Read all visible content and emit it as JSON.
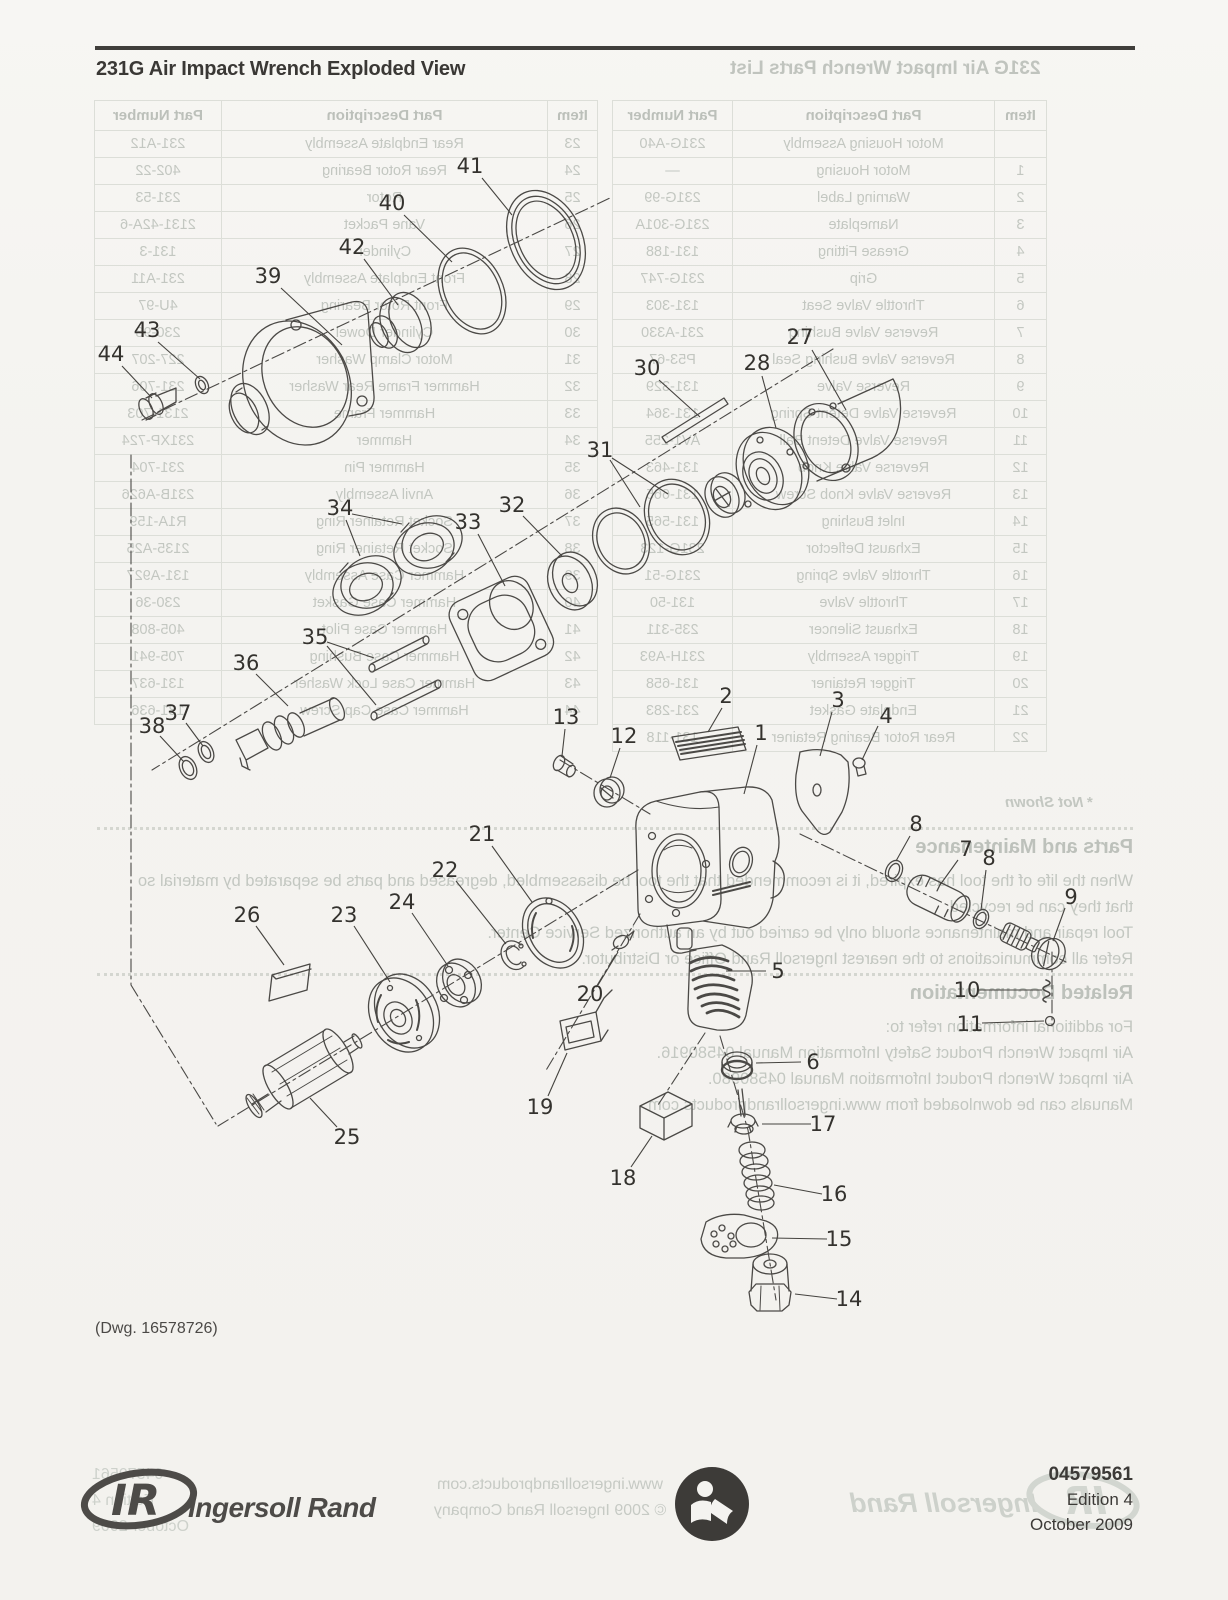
{
  "page": {
    "title": "231G Air Impact Wrench Exploded View",
    "dwg_note": "(Dwg. 16578726)"
  },
  "bleed": {
    "title": "231G Air Impact Wrench Parts List",
    "not_shown": "* Not Shown",
    "table": {
      "headers": [
        "Item",
        "Part Description",
        "Part Number"
      ],
      "rows_1_22": [
        [
          "",
          "Motor Housing Assembly",
          "231G-A40"
        ],
        [
          "1",
          "Motor Housing",
          "—"
        ],
        [
          "2",
          "Warning Label",
          "231G-99"
        ],
        [
          "3",
          "Nameplate",
          "231G-301A"
        ],
        [
          "4",
          "Grease Fitting",
          "131-188"
        ],
        [
          "5",
          "Grip",
          "231G-747"
        ],
        [
          "6",
          "Throttle Valve Seat",
          "131-303"
        ],
        [
          "7",
          "Reverse Valve Bushing",
          "231-A330"
        ],
        [
          "8",
          "Reverse Valve Bushing Seal",
          "P53-67"
        ],
        [
          "9",
          "Reverse Valve",
          "131-329"
        ],
        [
          "10",
          "Reverse Valve Detent Spring",
          "131-364"
        ],
        [
          "11",
          "Reverse Valve Detent Ball",
          "AV1-255"
        ],
        [
          "12",
          "Reverse Valve Knob",
          "131-463"
        ],
        [
          "13",
          "Reverse Valve Knob Screw",
          "131-665"
        ],
        [
          "14",
          "Inlet Bushing",
          "131-565"
        ],
        [
          "15",
          "Exhaust Deflector",
          "231G-123"
        ],
        [
          "16",
          "Throttle Valve Spring",
          "231G-51"
        ],
        [
          "17",
          "Throttle Valve",
          "131-50"
        ],
        [
          "18",
          "Exhaust Silencer",
          "235-311"
        ],
        [
          "19",
          "Trigger Assembly",
          "231H-A93"
        ],
        [
          "20",
          "Trigger Retainer",
          "131-658"
        ],
        [
          "21",
          "Endplate Gasket",
          "231-283"
        ],
        [
          "22",
          "Rear Rotor Bearing Retainer",
          "131-118"
        ]
      ],
      "rows_23_44": [
        [
          "23",
          "Rear Endplate Assembly",
          "231-A12"
        ],
        [
          "24",
          "Rear Rotor Bearing",
          "402-22"
        ],
        [
          "25",
          "Rotor",
          "231-53"
        ],
        [
          "26",
          "Vane Packet",
          "2131-42A-6"
        ],
        [
          "27",
          "Cylinder",
          "131-3"
        ],
        [
          "28",
          "Front Endplate Assembly",
          "231-A11"
        ],
        [
          "29",
          "Front Rotor Bearing",
          "4U-97"
        ],
        [
          "30",
          "Cylinder Dowel",
          "230-98"
        ],
        [
          "31",
          "Motor Clamp Washer",
          "227-207"
        ],
        [
          "32",
          "Hammer Frame Rear Washer",
          "231-706"
        ],
        [
          "33",
          "Hammer Frame",
          "2131-703"
        ],
        [
          "34",
          "Hammer",
          "231XP-724"
        ],
        [
          "35",
          "Hammer Pin",
          "231-704"
        ],
        [
          "36",
          "Anvil Assembly",
          "231B-A626"
        ],
        [
          "37",
          "Socket Retainer Ring",
          "R1A-159"
        ],
        [
          "38",
          "Socket Retainer Ring",
          "2135-A25"
        ],
        [
          "39",
          "Hammer Case Assembly",
          "131-A927"
        ],
        [
          "40",
          "Hammer Case Gasket",
          "230-36"
        ],
        [
          "41",
          "Hammer Case Pilot",
          "405-808"
        ],
        [
          "42",
          "Hammer Case Bushing",
          "705-941"
        ],
        [
          "43",
          "Hammer Case Lock Washer",
          "131-637"
        ],
        [
          "44",
          "Hammer Case Cap Screw",
          "131-636"
        ]
      ]
    },
    "sections": [
      {
        "heading": "Parts and Maintenance",
        "top": 836,
        "lines": [
          "When the life of the tool has expired, it is recommended that the tool be disassembled, degreased and parts be separated by material so",
          "that they can be recycled.",
          "Tool repair and maintenance should only be carried out by an authorized Service Center.",
          "Refer all communications to the nearest Ingersoll Rand Office or Distributor."
        ]
      },
      {
        "heading": "Related Documentation",
        "top": 982,
        "lines": [
          "For additional information refer to:",
          "Air Impact Wrench Product Safety Information Manual 04580916.",
          "Air Impact Wrench Product Information Manual 04580980.",
          "Manuals can be downloaded from www.ingersollrandproducts.com"
        ]
      }
    ],
    "footer_center": [
      "www.ingersollrandproducts.com",
      "© 2009 Ingersoll Rand Company"
    ],
    "footer_left": [
      "04579561",
      "Edition 4",
      "October 2009"
    ],
    "footer_brand": "Ingersoll Rand"
  },
  "footer": {
    "logo_text": "IR",
    "brand": "Ingersoll Rand",
    "doc_number": "04579561",
    "edition": "Edition 4",
    "date": "October 2009"
  },
  "diagram": {
    "callouts": [
      {
        "n": "41",
        "x": 470,
        "y": 166,
        "leaders": [
          [
            482,
            178,
            512,
            215
          ]
        ]
      },
      {
        "n": "40",
        "x": 392,
        "y": 203,
        "leaders": [
          [
            404,
            215,
            452,
            262
          ]
        ]
      },
      {
        "n": "42",
        "x": 352,
        "y": 247,
        "leaders": [
          [
            364,
            259,
            398,
            305
          ]
        ]
      },
      {
        "n": "39",
        "x": 268,
        "y": 276,
        "leaders": [
          [
            281,
            288,
            342,
            345
          ]
        ]
      },
      {
        "n": "43",
        "x": 147,
        "y": 330,
        "leaders": [
          [
            158,
            342,
            200,
            379
          ]
        ]
      },
      {
        "n": "44",
        "x": 111,
        "y": 354,
        "leaders": [
          [
            122,
            366,
            152,
            398
          ]
        ]
      },
      {
        "n": "27",
        "x": 800,
        "y": 337,
        "leaders": [
          [
            812,
            350,
            846,
            410
          ]
        ]
      },
      {
        "n": "28",
        "x": 757,
        "y": 363,
        "leaders": [
          [
            762,
            376,
            776,
            428
          ]
        ]
      },
      {
        "n": "30",
        "x": 647,
        "y": 368,
        "leaders": [
          [
            659,
            380,
            700,
            417
          ]
        ]
      },
      {
        "n": "31",
        "x": 600,
        "y": 450,
        "leaders": [
          [
            610,
            460,
            640,
            507
          ],
          [
            612,
            458,
            668,
            494
          ]
        ]
      },
      {
        "n": "32",
        "x": 512,
        "y": 505,
        "leaders": [
          [
            523,
            516,
            562,
            556
          ]
        ]
      },
      {
        "n": "33",
        "x": 468,
        "y": 522,
        "leaders": [
          [
            478,
            534,
            505,
            586
          ]
        ]
      },
      {
        "n": "34",
        "x": 340,
        "y": 508,
        "leaders": [
          [
            346,
            520,
            360,
            556
          ],
          [
            352,
            514,
            402,
            524
          ]
        ]
      },
      {
        "n": "35",
        "x": 315,
        "y": 637,
        "leaders": [
          [
            327,
            642,
            374,
            658
          ],
          [
            327,
            646,
            376,
            705
          ]
        ]
      },
      {
        "n": "36",
        "x": 246,
        "y": 663,
        "leaders": [
          [
            256,
            674,
            288,
            706
          ]
        ]
      },
      {
        "n": "37",
        "x": 178,
        "y": 713,
        "leaders": [
          [
            186,
            723,
            203,
            746
          ]
        ]
      },
      {
        "n": "38",
        "x": 152,
        "y": 726,
        "leaders": [
          [
            160,
            736,
            184,
            762
          ]
        ]
      },
      {
        "n": "2",
        "x": 726,
        "y": 696,
        "leaders": [
          [
            722,
            708,
            708,
            732
          ]
        ]
      },
      {
        "n": "3",
        "x": 838,
        "y": 700,
        "leaders": [
          [
            832,
            712,
            820,
            756
          ]
        ]
      },
      {
        "n": "4",
        "x": 886,
        "y": 716,
        "leaders": [
          [
            878,
            726,
            862,
            760
          ]
        ]
      },
      {
        "n": "13",
        "x": 566,
        "y": 717,
        "leaders": [
          [
            565,
            729,
            562,
            756
          ]
        ]
      },
      {
        "n": "12",
        "x": 624,
        "y": 736,
        "leaders": [
          [
            620,
            748,
            610,
            778
          ]
        ]
      },
      {
        "n": "1",
        "x": 761,
        "y": 733,
        "leaders": [
          [
            757,
            745,
            744,
            794
          ]
        ]
      },
      {
        "n": "8",
        "x": 916,
        "y": 824,
        "leaders": [
          [
            910,
            836,
            896,
            861
          ]
        ]
      },
      {
        "n": "7",
        "x": 966,
        "y": 849,
        "leaders": [
          [
            958,
            860,
            940,
            885
          ]
        ]
      },
      {
        "n": "8",
        "x": 989,
        "y": 858,
        "leaders": [
          [
            986,
            870,
            981,
            910
          ]
        ]
      },
      {
        "n": "9",
        "x": 1071,
        "y": 897,
        "leaders": [
          [
            1065,
            908,
            1053,
            941
          ]
        ]
      },
      {
        "n": "21",
        "x": 482,
        "y": 834,
        "leaders": [
          [
            492,
            846,
            532,
            902
          ]
        ]
      },
      {
        "n": "22",
        "x": 445,
        "y": 870,
        "leaders": [
          [
            456,
            881,
            506,
            944
          ]
        ]
      },
      {
        "n": "24",
        "x": 402,
        "y": 902,
        "leaders": [
          [
            412,
            913,
            448,
            966
          ]
        ]
      },
      {
        "n": "23",
        "x": 344,
        "y": 915,
        "leaders": [
          [
            354,
            926,
            390,
            982
          ]
        ]
      },
      {
        "n": "26",
        "x": 247,
        "y": 915,
        "leaders": [
          [
            256,
            926,
            284,
            965
          ]
        ]
      },
      {
        "n": "20",
        "x": 590,
        "y": 994,
        "leaders": [
          [
            598,
            985,
            618,
            952
          ]
        ]
      },
      {
        "n": "5",
        "x": 778,
        "y": 971,
        "leaders": [
          [
            766,
            971,
            726,
            971
          ]
        ]
      },
      {
        "n": "19",
        "x": 540,
        "y": 1107,
        "leaders": [
          [
            548,
            1096,
            567,
            1053
          ]
        ]
      },
      {
        "n": "25",
        "x": 347,
        "y": 1137,
        "leaders": [
          [
            337,
            1127,
            310,
            1098
          ]
        ]
      },
      {
        "n": "18",
        "x": 623,
        "y": 1178,
        "leaders": [
          [
            631,
            1167,
            652,
            1136
          ]
        ]
      },
      {
        "n": "6",
        "x": 813,
        "y": 1062,
        "leaders": [
          [
            801,
            1062,
            756,
            1063
          ]
        ]
      },
      {
        "n": "17",
        "x": 823,
        "y": 1124,
        "leaders": [
          [
            811,
            1124,
            762,
            1124
          ]
        ]
      },
      {
        "n": "16",
        "x": 834,
        "y": 1194,
        "leaders": [
          [
            822,
            1194,
            774,
            1185
          ]
        ]
      },
      {
        "n": "15",
        "x": 839,
        "y": 1239,
        "leaders": [
          [
            827,
            1239,
            772,
            1238
          ]
        ]
      },
      {
        "n": "14",
        "x": 849,
        "y": 1299,
        "leaders": [
          [
            837,
            1299,
            795,
            1294
          ]
        ]
      },
      {
        "n": "10",
        "x": 967,
        "y": 990,
        "leaders": [
          [
            979,
            990,
            1042,
            990
          ]
        ]
      },
      {
        "n": "11",
        "x": 970,
        "y": 1024,
        "leaders": [
          [
            982,
            1023,
            1044,
            1021
          ]
        ]
      }
    ]
  }
}
